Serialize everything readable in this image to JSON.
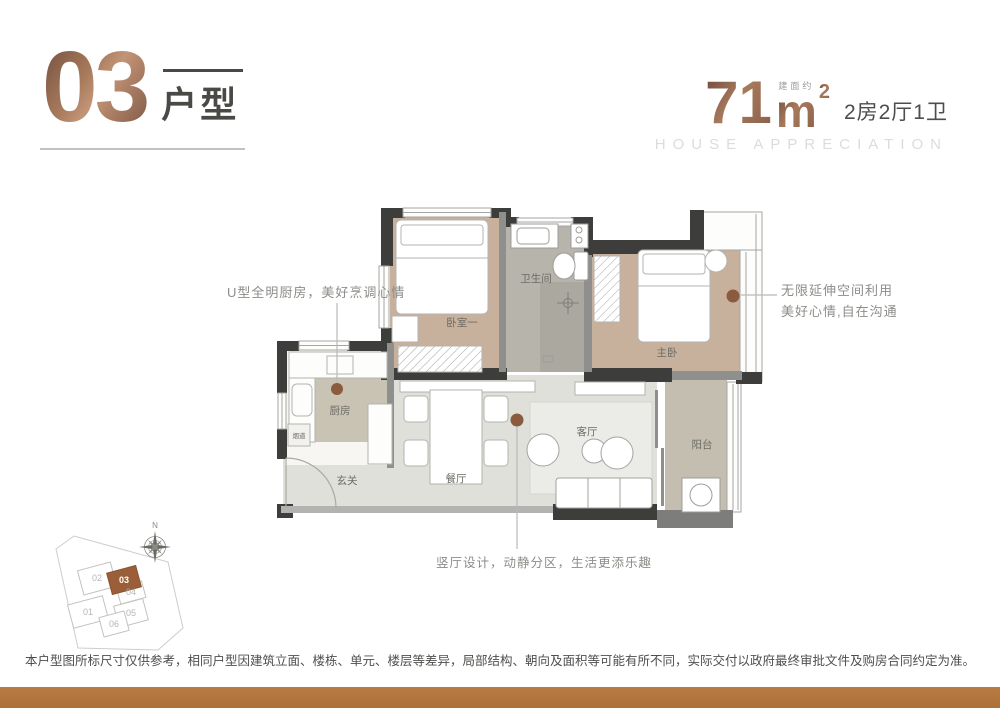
{
  "header": {
    "unit_number": "03",
    "unit_label": "户型",
    "area_prefix": "建面约",
    "area_value": "71",
    "area_unit": "m",
    "area_sup": "2",
    "layout": "2房2厅1卫",
    "subtitle_en": "HOUSE APPRECIATION"
  },
  "floorplan": {
    "rooms": {
      "bedroom1": "卧室一",
      "bathroom": "卫生间",
      "master": "主卧",
      "kitchen": "厨房",
      "flue": "烟道",
      "entry": "玄关",
      "dining": "餐厅",
      "living": "客厅",
      "balcony": "阳台"
    }
  },
  "annotations": {
    "kitchen": "U型全明厨房，美好烹调心情",
    "master_line1": "无限延伸空间利用",
    "master_line2": "美好心情,自在沟通",
    "living": "竖厅设计，动静分区，生活更添乐趣"
  },
  "siteplan": {
    "compass_n": "N",
    "units": [
      "01",
      "02",
      "03",
      "04",
      "05",
      "06"
    ],
    "highlighted_unit": "03"
  },
  "disclaimer": "本户型图所标尺寸仅供参考，相同户型因建筑立面、楼栋、单元、楼层等差异，局部结构、朝向及面积等可能有所不同，实际交付以政府最终审批文件及购房合同约定为准。",
  "colors": {
    "bronze": "#9b6e55",
    "accent_dot": "#8a5b3f",
    "wall_dark": "#3d3d3b",
    "floor_wood": "#c8b19c",
    "floor_tile_bath": "#b7b4ac",
    "floor_light": "#e0e0da",
    "bottom_bar": "#b2763e"
  }
}
